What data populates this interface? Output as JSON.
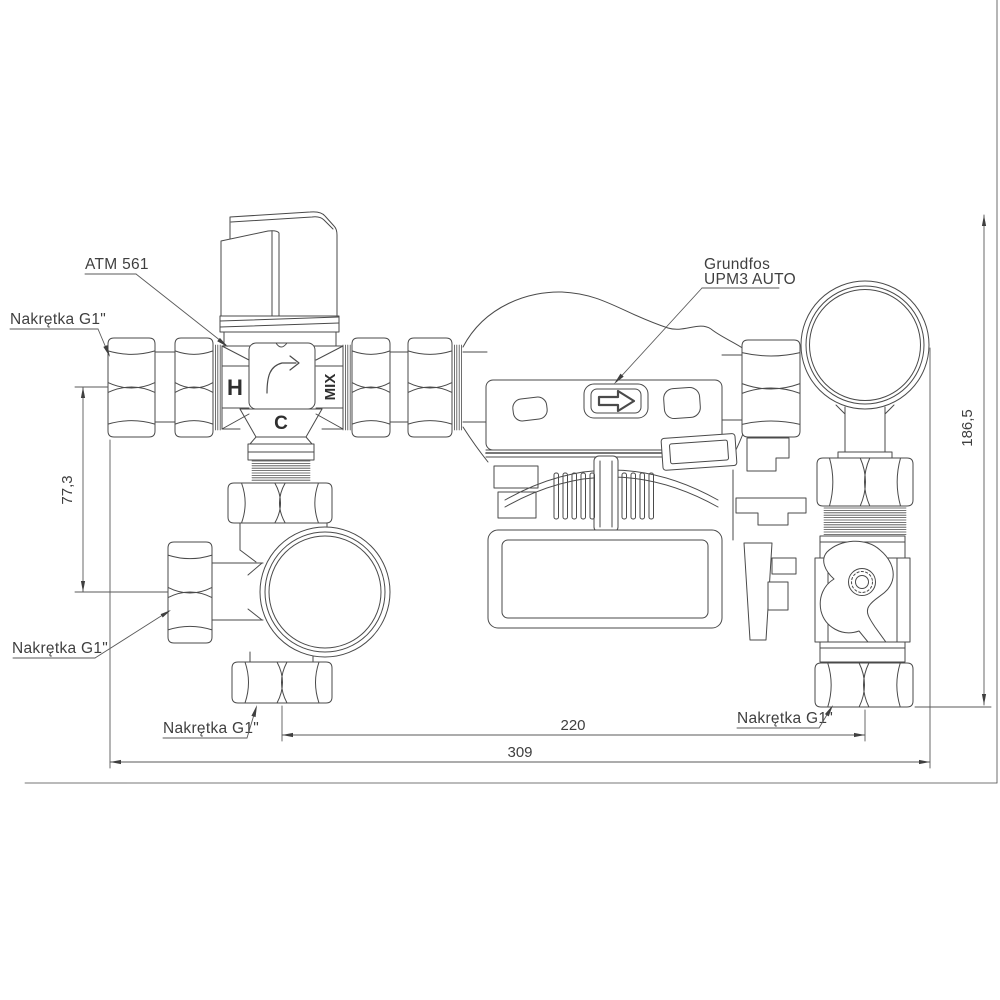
{
  "drawing": {
    "background": "#ffffff",
    "line_color": "#4a4a4a",
    "labels": {
      "valve_model": "ATM 561",
      "nut_top_left": "Nakrętka G1\"",
      "nut_mid_left": "Nakrętka G1\"",
      "nut_bottom_center": "Nakrętka G1\"",
      "nut_bottom_right": "Nakrętka G1\"",
      "pump_brand": "Grundfos",
      "pump_model": "UPM3 AUTO"
    },
    "valve_ports": {
      "hot": "H",
      "mixed": "MIX",
      "cold": "C"
    },
    "dimensions_mm": {
      "valve_to_tee_height": "77,3",
      "total_height": "186,5",
      "pump_center_span": "220",
      "total_width": "309"
    }
  }
}
